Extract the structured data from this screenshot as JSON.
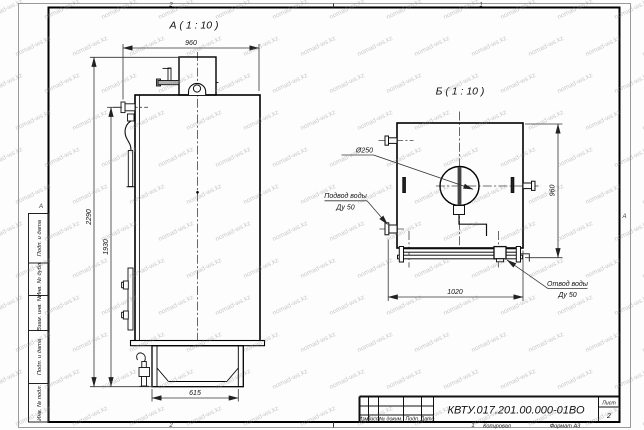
{
  "watermark": {
    "text": "nomad-ws.kz"
  },
  "frame": {
    "zones": {
      "top_left": "2",
      "top_right": "1",
      "bottom_left": "2",
      "bottom_right": "1",
      "left": "А",
      "right": "А"
    }
  },
  "view_a": {
    "title": "А ( 1 : 10 )",
    "dim_width": "960",
    "dim_height_total": "2290",
    "dim_height_body": "1930",
    "dim_base": "615"
  },
  "view_b": {
    "title": "Б ( 1 : 10 )",
    "dim_width": "1020",
    "dim_height": "960",
    "label_diameter": "Ø250",
    "inlet": {
      "line1": "Подвод воды",
      "line2": "Ду 50"
    },
    "outlet": {
      "line1": "Отвод воды",
      "line2": "Ду 50"
    }
  },
  "side_strip": {
    "cells": [
      "Подп. и дата",
      "Инв. № дубл.",
      "Взам. инв. №",
      "Подп. и дата",
      "Инв. № подл."
    ]
  },
  "title_block": {
    "doc_number": "КВТУ.017.201.00.000-01ВО",
    "col_izm": "Изм.",
    "col_list": "Лист",
    "col_docnum": "№ докум.",
    "col_podp": "Подп.",
    "col_data": "Дата",
    "sheet_label": "Лист",
    "sheet_number": "2"
  },
  "footer": {
    "copied": "Копировал",
    "format": "Формат А3"
  }
}
